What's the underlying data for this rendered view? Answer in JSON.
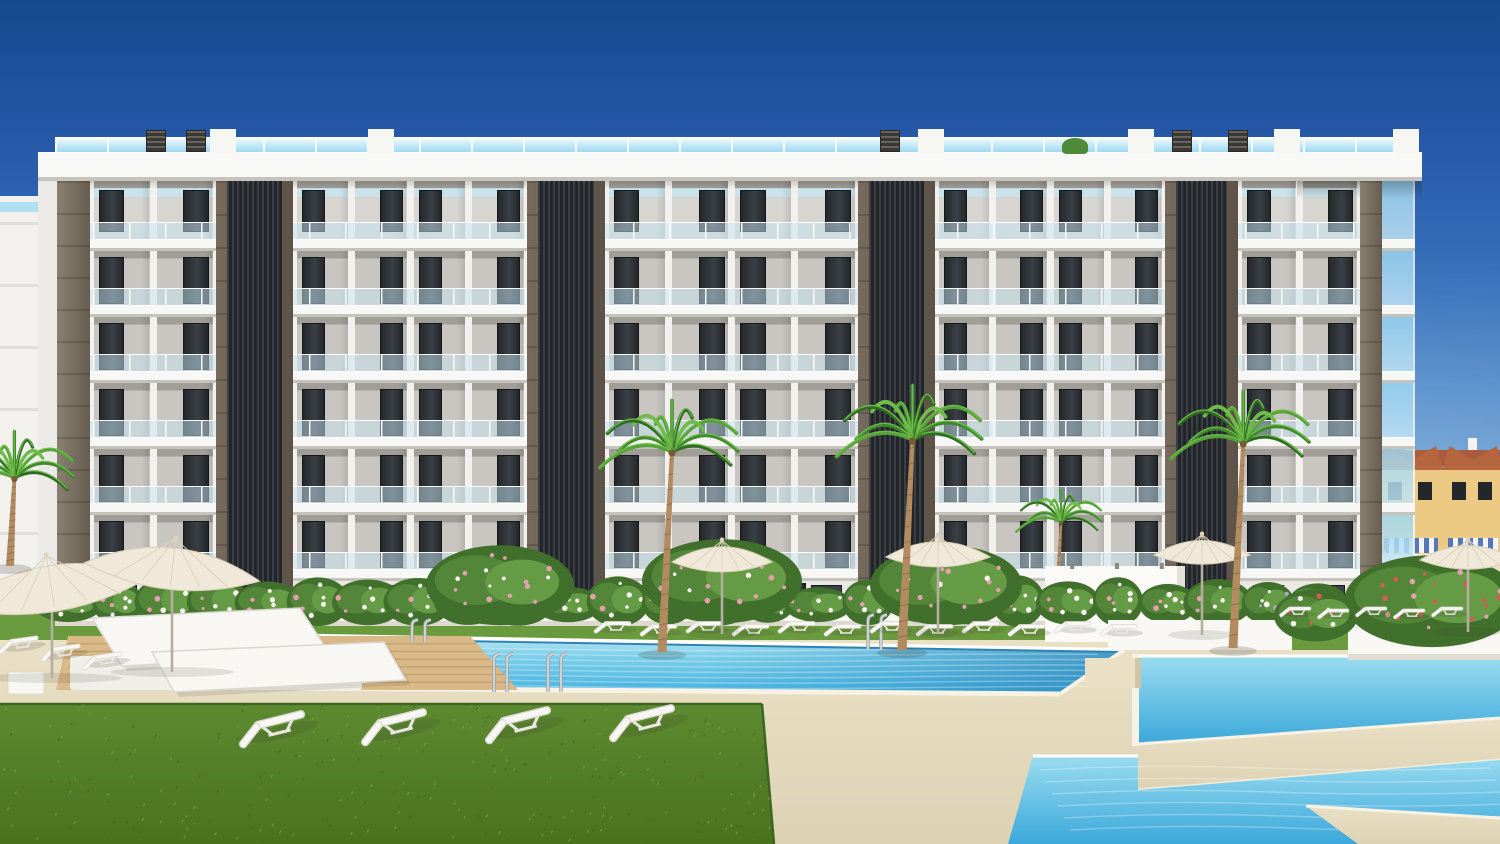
{
  "meta": {
    "description": "Photorealistic architectural render: modern 6-storey white apartment block with dark louvered cores, rooftop glass railing, communal pools, palm trees, lawns and sun loungers under a clear blue sky",
    "canvas": {
      "w": 1500,
      "h": 844
    }
  },
  "palette": {
    "sky": [
      "#17498f",
      "#2456a6",
      "#3c76bf",
      "#69a2d5",
      "#a5d1ec",
      "#c9e6f5"
    ],
    "fascia": "#f8f8f6",
    "slab": "#f7f7f5",
    "slab_edge": "#c6c3bd",
    "facade_white": "#f2f1ee",
    "panel": "#c9c6c1",
    "panel_top": "#a19d97",
    "panel_r0": "#d7d5d0",
    "window_a": "#24272a",
    "window_b": "#3a4046",
    "glass": "rgba(200,228,242,0.50)",
    "glass_side_a": "#9ed8f2",
    "glass_side_b": "#c3e7f6",
    "rail_a": "#eaf8fd",
    "rail_b": "#9fd9f2",
    "tower_frame_a": "#776b5e",
    "tower_frame_b": "#5c5248",
    "louver_a": "#3a4046",
    "louver_b": "#22262a",
    "corner_a": "#8a8072",
    "corner_b": "#675d50",
    "ground_wall": "#eae8e3",
    "entrance": "#2c2f33",
    "vent": "#3b3833",
    "bulkhead": "#f6f6f3",
    "roof_plant": "#4f8a38",
    "deck": "#e9e0c5",
    "deck_dark": "#ddd2b4",
    "deck_edge": "#cfc4a4",
    "grass": "#6a9a3e",
    "grass_dark": "#4e7a28",
    "lawn_a": "#5d8a31",
    "lawn_b": "#49721f",
    "pool_a": "#c8eaf4",
    "pool_b": "#7fd0ea",
    "pool_c": "#45b2e0",
    "pool_deep": "#2486be",
    "waterline": "#2f83b4",
    "coping": "#f7f2e3",
    "wood": "#d9b988",
    "wood_line": "#c29e6b",
    "white": "#f8f7f4",
    "furn_stroke": "#dbd8d2",
    "furn_shadow": "rgba(60,60,45,0.16)",
    "umb_a": "#f0e9d9",
    "umb_b": "#ddd3bd",
    "pole": "#b5ae9f",
    "trunk": "#b28c60",
    "trunk_ring": "#93714a",
    "palm_greens": [
      "#2f6b25",
      "#3f8a2d",
      "#55a338",
      "#6fbc49"
    ],
    "bush_greens": [
      "#41702d",
      "#54863a",
      "#669b46"
    ],
    "fl_white": "#f7f4f1",
    "fl_pink": "#e3a0af",
    "fl_red": "#cf5f52",
    "fl_purple": "#aaa6cf",
    "chrome": "#d5d8da",
    "chrome_dark": "#9aa0a4",
    "house_wall": "#ecca84",
    "house_wall2": "#f2debe",
    "roof": "#b5663f",
    "roof_dark": "#a85c3d",
    "awning": "#5577b5",
    "path": "#cb8a72",
    "fence": "#f6f4ee",
    "terrace_green": "#4e7c33",
    "terrace_dot": "#39602a",
    "terrace_wall": "#cfc8b4",
    "bgl_orange": "#bf6a44",
    "bgl_orange2": "#d08a5f",
    "bgl_red": "#a03d2a",
    "bgl_roof": "#a84f30",
    "bgl_win": "#2f555c",
    "tree_a": "#4a7c33",
    "tree_b": "#3e6c2b",
    "tree_c": "#568c3c"
  },
  "building": {
    "fascia": {
      "x": 38,
      "w": 1384,
      "y": 152,
      "h": 29
    },
    "rail": {
      "x": 55,
      "w": 1351,
      "y": 137,
      "h": 15
    },
    "slab": {
      "x": 57,
      "w": 1358,
      "h": 12
    },
    "slab_ys": [
      239,
      305,
      371,
      437,
      503,
      569
    ],
    "body": {
      "x": 57,
      "w": 1325
    },
    "sections": [
      {
        "x": 90,
        "w": 126,
        "bays": 2
      },
      {
        "x": 293,
        "w": 234,
        "bays": 4
      },
      {
        "x": 605,
        "w": 253,
        "bays": 4
      },
      {
        "x": 935,
        "w": 230,
        "bays": 4
      },
      {
        "x": 1238,
        "w": 122,
        "bays": 2
      }
    ],
    "towers": [
      {
        "x": 216,
        "w": 77
      },
      {
        "x": 527,
        "w": 78
      },
      {
        "x": 858,
        "w": 77
      },
      {
        "x": 1165,
        "w": 73
      }
    ],
    "corner_left": {
      "x": 57,
      "w": 33
    },
    "corner_right": {
      "x": 1360,
      "w": 22
    },
    "side_glass": {
      "x": 1382,
      "w": 33
    },
    "left_wall": {
      "x": 38,
      "w": 19
    },
    "ground": {
      "y": 581,
      "h": 64,
      "wall_x": 90,
      "wall_w": 1270,
      "entrance": {
        "x": 742,
        "w": 64
      }
    },
    "bottom": 645,
    "vents": [
      146,
      186,
      880,
      1172,
      1228
    ],
    "bulkheads": [
      210,
      368,
      918,
      1128,
      1274,
      1393
    ],
    "roof_plant_x": 1062,
    "neighbor_left": {
      "x": 0,
      "y": 196,
      "w": 38,
      "h": 448
    }
  },
  "bg_left": {
    "blocks": [
      {
        "r": [
          58,
          352,
          62,
          210
        ],
        "c": "bgl_orange"
      },
      {
        "r": [
          112,
          396,
          54,
          166
        ],
        "c": "bgl_orange2"
      },
      {
        "r": [
          88,
          346,
          64,
          14
        ],
        "c": "bgl_roof"
      },
      {
        "r": [
          58,
          520,
          40,
          42
        ],
        "c": "bgl_red"
      },
      {
        "r": [
          40,
          542,
          76,
          40
        ],
        "c": "fence"
      }
    ],
    "win_grids": [
      {
        "cols": [
          66,
          92
        ],
        "y0": 362,
        "rows": 5,
        "dy": 38,
        "w": 16,
        "h": 22
      },
      {
        "cols": [
          120,
          142
        ],
        "y0": 404,
        "rows": 4,
        "dy": 40,
        "w": 14,
        "h": 20
      }
    ],
    "trees": [
      {
        "x": 84,
        "y": 425,
        "w": 66,
        "h": 95,
        "c": "tree_a"
      },
      {
        "x": 152,
        "y": 440,
        "w": 48,
        "h": 70,
        "c": "tree_c"
      },
      {
        "x": 126,
        "y": 468,
        "w": 78,
        "h": 112,
        "c": "tree_b"
      },
      {
        "x": 56,
        "y": 512,
        "w": 58,
        "h": 84,
        "c": "tree_c"
      },
      {
        "x": 124,
        "y": 556,
        "w": 92,
        "h": 84,
        "c": "tree_b"
      }
    ],
    "pink_bush": {
      "x": 42,
      "y": 574,
      "w": 44,
      "h": 34
    }
  },
  "bg_right": {
    "units": [
      {
        "x": 1378,
        "w": 66
      },
      {
        "x": 1442,
        "w": 62
      }
    ],
    "roof_y": 446,
    "wall_y": 470,
    "awning_y": 538,
    "rail_y": 554,
    "base_y": 566,
    "base_h": 26,
    "terraces": [
      [
        1382,
        588,
        118,
        14
      ],
      [
        1376,
        604,
        124,
        16
      ],
      [
        1370,
        622,
        130,
        16
      ]
    ],
    "path": [
      1378,
      640,
      122,
      16
    ],
    "fence": [
      1382,
      596,
      118,
      7
    ]
  },
  "grounds": {
    "grass_strip": [
      0,
      614,
      1500,
      26
    ],
    "deck": [
      0,
      640,
      1500,
      204
    ],
    "wall": [
      55,
      596,
      1292,
      30
    ],
    "shower": [
      1045,
      566,
      140,
      76
    ],
    "main_pool": [
      [
        210,
        634
      ],
      [
        1124,
        650
      ],
      [
        1060,
        694
      ],
      [
        296,
        688
      ]
    ],
    "ur_pool": [
      [
        1138,
        656
      ],
      [
        1500,
        656
      ],
      [
        1500,
        718
      ],
      [
        1138,
        744
      ]
    ],
    "walkway1": [
      [
        1138,
        744
      ],
      [
        1500,
        718
      ],
      [
        1500,
        760
      ],
      [
        1138,
        790
      ]
    ],
    "lr_pool": [
      [
        1033,
        756
      ],
      [
        1138,
        756
      ],
      [
        1138,
        790
      ],
      [
        1500,
        760
      ],
      [
        1500,
        844
      ],
      [
        1008,
        844
      ]
    ],
    "walkway2": [
      [
        1306,
        806
      ],
      [
        1500,
        818
      ],
      [
        1500,
        844
      ],
      [
        1358,
        844
      ]
    ],
    "step": [
      1085,
      658,
      56,
      30
    ],
    "grass_right": [
      1150,
      628,
      350,
      22
    ],
    "lawn": [
      [
        0,
        704
      ],
      [
        762,
        704
      ],
      [
        774,
        844
      ],
      [
        0,
        844
      ]
    ],
    "wood": [
      [
        68,
        636
      ],
      [
        470,
        636
      ],
      [
        518,
        690
      ],
      [
        56,
        690
      ]
    ],
    "platform": [
      70,
      656,
      292,
      34
    ],
    "daybeds": [
      [
        [
          92,
          618
        ],
        [
          300,
          608
        ],
        [
          330,
          654
        ],
        [
          122,
          666
        ]
      ],
      [
        [
          152,
          652
        ],
        [
          384,
          642
        ],
        [
          406,
          680
        ],
        [
          174,
          692
        ]
      ]
    ],
    "planterB": [
      1108,
      620,
      184,
      30
    ],
    "planterA": [
      1348,
      606,
      152,
      54
    ],
    "ladders": [
      {
        "x": 494,
        "y1": 654,
        "y2": 692
      },
      {
        "x": 548,
        "y1": 654,
        "y2": 692
      },
      {
        "x": 868,
        "y1": 615,
        "y2": 650
      },
      {
        "x": 412,
        "y1": 620,
        "y2": 642
      }
    ]
  },
  "vegetation": {
    "palms": [
      {
        "x": 1056,
        "base": 622,
        "h": 100,
        "s": 0.62
      },
      {
        "x": 662,
        "base": 652,
        "h": 200,
        "s": 1.0
      },
      {
        "x": 902,
        "base": 650,
        "h": 210,
        "s": 1.05
      },
      {
        "x": 1233,
        "base": 648,
        "h": 205,
        "s": 1.0
      },
      {
        "x": 10,
        "base": 566,
        "h": 88,
        "s": 0.9
      }
    ],
    "hedge": {
      "x0": 68,
      "x1": 1330,
      "step": 50,
      "base": 612
    },
    "tall_bushes": [
      {
        "x": 500,
        "y": 586,
        "rx": 74,
        "ry": 40
      },
      {
        "x": 722,
        "y": 582,
        "rx": 80,
        "ry": 42
      },
      {
        "x": 946,
        "y": 586,
        "rx": 76,
        "ry": 40
      }
    ],
    "planterA_bush": {
      "x": 1432,
      "y": 602,
      "rx": 88,
      "ry": 46
    },
    "planterB_plants": {
      "x": 1316,
      "y": 616,
      "rx": 42,
      "ry": 26
    }
  },
  "furniture": {
    "umbrellas_big": [
      {
        "cx": 52,
        "cy": 592,
        "rx": 100,
        "ry": 28,
        "rot": -9,
        "pole": 86
      },
      {
        "cx": 172,
        "cy": 572,
        "rx": 88,
        "ry": 25,
        "rot": 6,
        "pole": 100
      }
    ],
    "umbrellas": [
      {
        "cx": 722,
        "cy": 562,
        "rx": 50,
        "ry": 14,
        "pole": 72
      },
      {
        "cx": 938,
        "cy": 557,
        "rx": 52,
        "ry": 14,
        "pole": 76
      },
      {
        "cx": 1202,
        "cy": 555,
        "rx": 48,
        "ry": 13,
        "pole": 80
      },
      {
        "cx": 1468,
        "cy": 560,
        "rx": 48,
        "ry": 13,
        "pole": 72
      }
    ],
    "back_loungers": {
      "y": 618,
      "xs": [
        604,
        650,
        696,
        742,
        788,
        834,
        880,
        926,
        972,
        1018,
        1064,
        1110
      ],
      "s": 1.0
    },
    "right_loungers": {
      "y": 604,
      "xs": [
        1288,
        1326,
        1364,
        1402,
        1440
      ],
      "s": 0.85
    },
    "left_loungers": {
      "pts": [
        [
          8,
          636
        ],
        [
          50,
          644
        ],
        [
          92,
          652
        ]
      ],
      "s": 1.1
    },
    "front_loungers": {
      "pts": [
        [
          252,
          716
        ],
        [
          374,
          714
        ],
        [
          498,
          712
        ],
        [
          622,
          710
        ]
      ],
      "s": 1.9,
      "rot": -14
    },
    "cube": [
      8,
      672,
      36,
      22
    ]
  }
}
